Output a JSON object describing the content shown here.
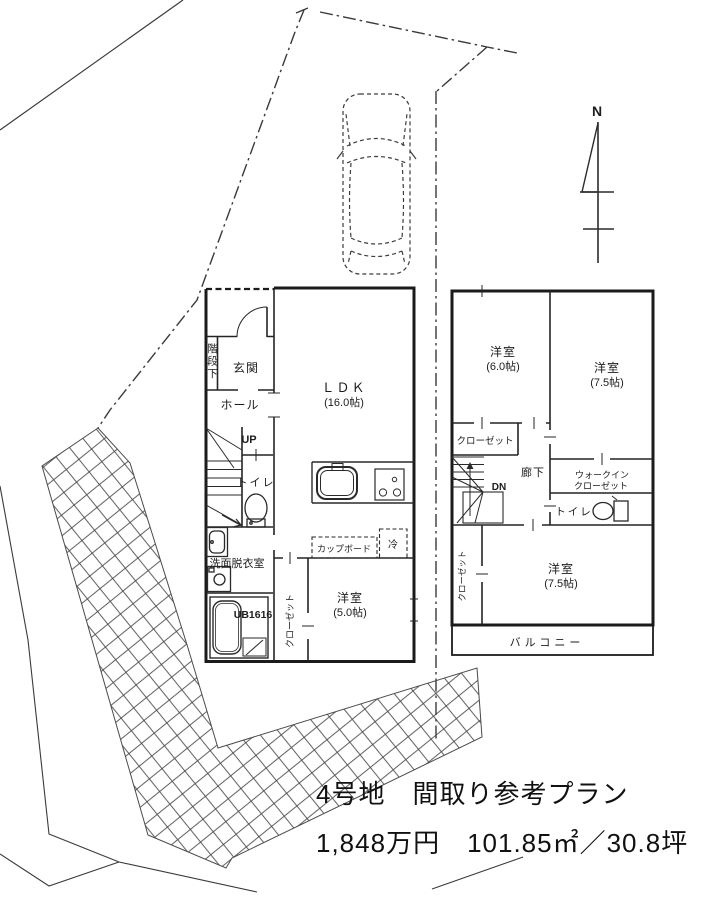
{
  "caption": {
    "line1": "4号地　間取り参考プラン",
    "line2": "1,848万円　101.85㎡／30.8坪"
  },
  "compass": {
    "north": "N"
  },
  "colors": {
    "ink": "#2a2a2a",
    "wall": "#1b1b1b"
  },
  "floor1": {
    "understairs": "階段下",
    "entrance": "玄関",
    "hall": "ホール",
    "stairs_up": "UP",
    "toilet": "トイレ",
    "washroom": "洗面脱衣室",
    "bath_unit": "UB1616",
    "closet": "クローゼット",
    "bedroom": "洋室",
    "bedroom_size": "(5.0帖)",
    "ldk": "ＬＤＫ",
    "ldk_size": "(16.0帖)",
    "cupboard": "カップボード",
    "fridge": "冷"
  },
  "floor2": {
    "bedroom1": "洋室",
    "bedroom1_size": "(6.0帖)",
    "bedroom2": "洋室",
    "bedroom2_size": "(7.5帖)",
    "closet": "クローゼット",
    "hallway": "廊下",
    "stairs_down": "DN",
    "wic_line1": "ウォークイン",
    "wic_line2": "クローゼット",
    "toilet": "トイレ",
    "closet_side": "クローゼット",
    "bedroom3": "洋室",
    "bedroom3_size": "(7.5帖)",
    "balcony": "バルコニー"
  }
}
